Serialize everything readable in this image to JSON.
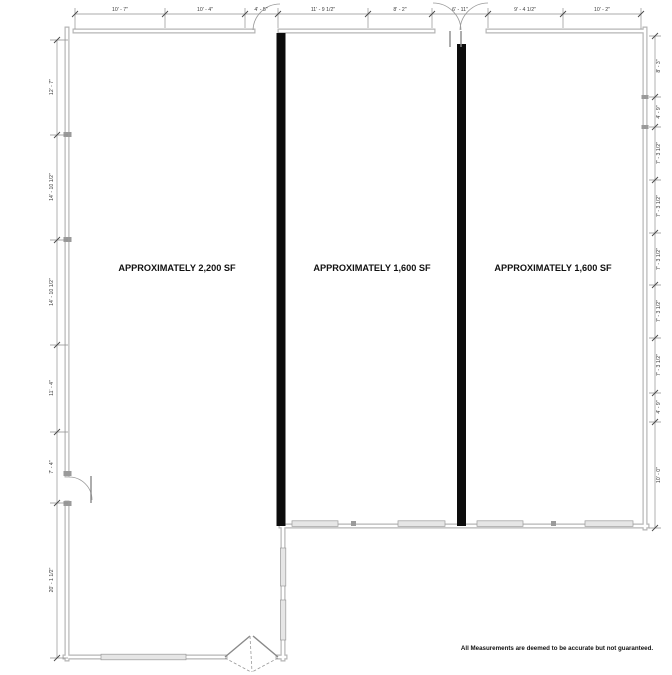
{
  "plan": {
    "units": [
      {
        "label": "APPROXIMATELY 2,200 SF"
      },
      {
        "label": "APPROXIMATELY 1,600 SF"
      },
      {
        "label": "APPROXIMATELY 1,600 SF"
      }
    ],
    "disclaimer": "All Measurements are deemed to be accurate but not guaranteed.",
    "dimensions": {
      "top": [
        "10' - 7\"",
        "10' - 4\"",
        "4' - 5\"",
        "11' - 9 1/2\"",
        "8' - 2\"",
        "6' - 11\"",
        "9' - 4 1/2\"",
        "10' - 2\""
      ],
      "left": [
        "12' - 7\"",
        "14' - 10 1/2\"",
        "14' - 10 1/2\"",
        "11' - 4\"",
        "7' - 4\"",
        "20' - 1 1/2\""
      ],
      "right": [
        "8' - 3\"",
        "4' - 9\"",
        "7' - 3 1/2\"",
        "7' - 3 1/2\"",
        "7' - 3 1/2\"",
        "7' - 3 1/2\"",
        "7' - 3 1/2\"",
        "4' - 9\"",
        "10' - 0\""
      ]
    },
    "colors": {
      "wall_gray": "#b6b6b6",
      "demising_black": "#0c0c0c",
      "dimension_gray": "#8f8f8f",
      "text_black": "#111111"
    }
  }
}
